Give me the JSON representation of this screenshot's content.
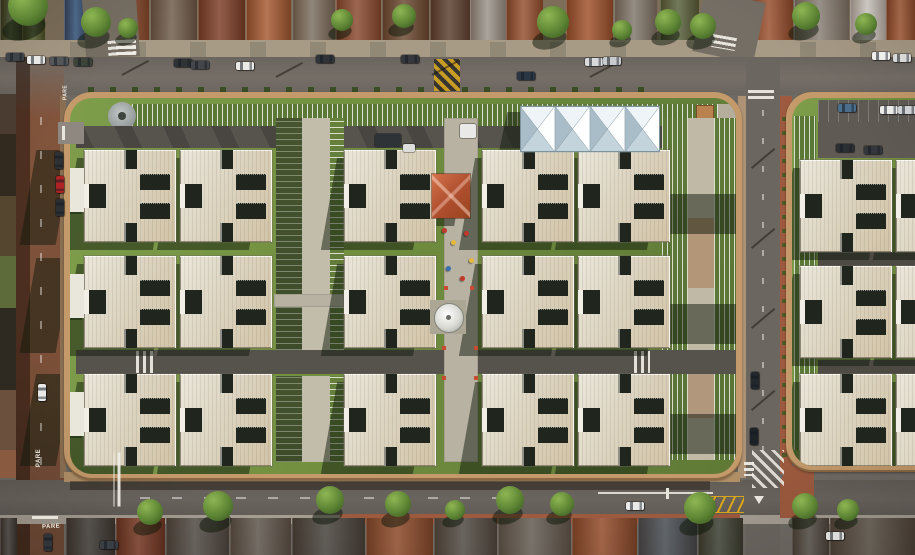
{
  "meta": {
    "scene_title": "Aerial drone view of a residential condominium complex with cross-shaped apartment blocks",
    "road_stop_text": "PARE"
  },
  "palette": {
    "grass": "#74923f",
    "grassDark": "#5d7a34",
    "shade": "rgba(16,26,11,0.5)",
    "roofLight": "#ebe7db",
    "roofMid": "#dcd4c0",
    "roofWarm": "#d2c3a6",
    "slot": "#20261d",
    "wall": "#c49a6a",
    "asphalt": "#716b64",
    "asphaltDark": "#57534d",
    "redRoad": "#7d5038",
    "sidewalk": "#a89b86",
    "sidewalkRed": "#9d5a3e",
    "sidewalkTan": "#b08f67",
    "concrete": "#c2bcaa",
    "path": "#b8b2a2",
    "tentWhite": "#f3f7f9",
    "tentShade": "#a9bdc8",
    "communityRoof": "#b65430",
    "tank": "#ecedea",
    "stripeLine": "rgba(248,248,240,0.8)"
  },
  "topHouses": [
    {
      "x": 0,
      "w": 22,
      "c": "#37411f"
    },
    {
      "x": 22,
      "w": 22,
      "c": "#4f5a2a"
    },
    {
      "x": 64,
      "w": 24,
      "c": "#30507a"
    },
    {
      "x": 92,
      "w": 56,
      "c": "#8f4e2e"
    },
    {
      "x": 150,
      "w": 46,
      "c": "#6e5d4c"
    },
    {
      "x": 198,
      "w": 46,
      "c": "#7c3f28"
    },
    {
      "x": 246,
      "w": 44,
      "c": "#a55a32"
    },
    {
      "x": 292,
      "w": 42,
      "c": "#7b6f60"
    },
    {
      "x": 336,
      "w": 44,
      "c": "#8a4a30"
    },
    {
      "x": 382,
      "w": 46,
      "c": "#6b4a32"
    },
    {
      "x": 430,
      "w": 40,
      "c": "#5a3f2e"
    },
    {
      "x": 470,
      "w": 36,
      "c": "#9a938a"
    },
    {
      "x": 506,
      "w": 36,
      "c": "#95502f"
    },
    {
      "x": 566,
      "w": 46,
      "c": "#a0522c"
    },
    {
      "x": 614,
      "w": 42,
      "c": "#80786c"
    },
    {
      "x": 660,
      "w": 38,
      "c": "#56603a"
    },
    {
      "x": 748,
      "w": 44,
      "c": "#9c512f"
    },
    {
      "x": 794,
      "w": 54,
      "c": "#8d857a"
    },
    {
      "x": 850,
      "w": 36,
      "c": "#d5d0c8"
    },
    {
      "x": 886,
      "w": 29,
      "c": "#a2552f"
    }
  ],
  "leftEdge": [
    {
      "y": 94,
      "h": 40,
      "c": "#4a3c30"
    },
    {
      "y": 134,
      "h": 62,
      "c": "#32291f"
    },
    {
      "y": 196,
      "h": 60,
      "c": "#55462f"
    },
    {
      "y": 256,
      "h": 52,
      "c": "#5d6b3a"
    },
    {
      "y": 308,
      "h": 82,
      "c": "#2e2a22"
    },
    {
      "y": 390,
      "h": 60,
      "c": "#6b513d"
    },
    {
      "y": 450,
      "h": 28,
      "c": "#8a5a40"
    }
  ],
  "topTrees": [
    {
      "x": 28,
      "y": 6,
      "r": 20
    },
    {
      "x": 96,
      "y": 22,
      "r": 15
    },
    {
      "x": 128,
      "y": 28,
      "r": 10
    },
    {
      "x": 342,
      "y": 20,
      "r": 11
    },
    {
      "x": 404,
      "y": 16,
      "r": 12
    },
    {
      "x": 553,
      "y": 22,
      "r": 16
    },
    {
      "x": 622,
      "y": 30,
      "r": 10
    },
    {
      "x": 668,
      "y": 22,
      "r": 13
    },
    {
      "x": 703,
      "y": 26,
      "r": 13
    },
    {
      "x": 806,
      "y": 16,
      "r": 14
    },
    {
      "x": 866,
      "y": 24,
      "r": 11
    }
  ],
  "bottomTrees": [
    {
      "x": 150,
      "y": 512,
      "r": 13
    },
    {
      "x": 218,
      "y": 506,
      "r": 15
    },
    {
      "x": 330,
      "y": 500,
      "r": 14
    },
    {
      "x": 398,
      "y": 504,
      "r": 13
    },
    {
      "x": 455,
      "y": 510,
      "r": 10
    },
    {
      "x": 510,
      "y": 500,
      "r": 14
    },
    {
      "x": 562,
      "y": 504,
      "r": 12
    },
    {
      "x": 700,
      "y": 508,
      "r": 16
    },
    {
      "x": 805,
      "y": 506,
      "r": 13
    },
    {
      "x": 848,
      "y": 510,
      "r": 11
    }
  ],
  "driveways": [
    70,
    130,
    190,
    250,
    310,
    370,
    430,
    490,
    550,
    610,
    800,
    860
  ],
  "cars": {
    "top": [
      {
        "x": 6,
        "y": 53,
        "c": "#3f4448"
      },
      {
        "x": 27,
        "y": 56,
        "c": "#e8e8e6"
      },
      {
        "x": 50,
        "y": 57,
        "c": "#53575a"
      },
      {
        "x": 74,
        "y": 58,
        "c": "#3c4438"
      },
      {
        "x": 174,
        "y": 59,
        "c": "#2f3336"
      },
      {
        "x": 191,
        "y": 61,
        "c": "#43474b"
      },
      {
        "x": 236,
        "y": 62,
        "c": "#eceae6"
      },
      {
        "x": 316,
        "y": 55,
        "c": "#303438"
      },
      {
        "x": 401,
        "y": 55,
        "c": "#34383c"
      },
      {
        "x": 517,
        "y": 72,
        "c": "#2b3644"
      },
      {
        "x": 585,
        "y": 58,
        "c": "#d9dadb"
      },
      {
        "x": 603,
        "y": 57,
        "c": "#c8cbcd"
      },
      {
        "x": 872,
        "y": 52,
        "c": "#eeeeec"
      },
      {
        "x": 893,
        "y": 54,
        "c": "#d8d8d6"
      }
    ],
    "left": [
      {
        "x": 55,
        "y": 152,
        "c": "#2e3234"
      },
      {
        "x": 56,
        "y": 176,
        "c": "#b02324"
      },
      {
        "x": 56,
        "y": 199,
        "c": "#2c3033"
      },
      {
        "x": 38,
        "y": 384,
        "c": "#e9e9e7"
      },
      {
        "x": 44,
        "y": 534,
        "c": "#303539"
      }
    ],
    "right": [
      {
        "x": 751,
        "y": 372,
        "c": "#23282c"
      },
      {
        "x": 750,
        "y": 428,
        "c": "#1e2327"
      }
    ],
    "bottom": [
      {
        "x": 100,
        "y": 541,
        "c": "#3a3f43"
      },
      {
        "x": 626,
        "y": 502,
        "c": "#e9eae8"
      },
      {
        "x": 826,
        "y": 532,
        "c": "#dcdcda"
      }
    ],
    "compoundDrive": [
      {
        "x": 305,
        "y": 36,
        "w": 26,
        "h": 13,
        "c": "#2e3338"
      },
      {
        "x": 390,
        "y": 26,
        "w": 16,
        "h": 14,
        "c": "#e9eae8"
      },
      {
        "x": 333,
        "y": 46,
        "w": 12,
        "h": 8,
        "c": "#dddddc"
      }
    ],
    "rightCompound": [
      {
        "x": 46,
        "y": 6,
        "c": "#4b6e8c"
      },
      {
        "x": 88,
        "y": 8,
        "c": "#ebebe9"
      },
      {
        "x": 106,
        "y": 8,
        "c": "#cfd2d4"
      },
      {
        "x": 44,
        "y": 46,
        "c": "#2b2f33"
      },
      {
        "x": 72,
        "y": 48,
        "c": "#33373b"
      }
    ]
  },
  "mainBuildings": [
    {
      "x": 14,
      "y": 52
    },
    {
      "x": 110,
      "y": 52
    },
    {
      "x": 274,
      "y": 52
    },
    {
      "x": 412,
      "y": 52
    },
    {
      "x": 508,
      "y": 52
    },
    {
      "x": 14,
      "y": 158
    },
    {
      "x": 110,
      "y": 158
    },
    {
      "x": 274,
      "y": 158
    },
    {
      "x": 412,
      "y": 158
    },
    {
      "x": 508,
      "y": 158
    },
    {
      "x": 14,
      "y": 276
    },
    {
      "x": 110,
      "y": 276
    },
    {
      "x": 274,
      "y": 276
    },
    {
      "x": 412,
      "y": 276
    },
    {
      "x": 508,
      "y": 276
    }
  ],
  "rightBuildings": [
    {
      "x": 8,
      "y": 62
    },
    {
      "x": 104,
      "y": 62
    },
    {
      "x": 8,
      "y": 168
    },
    {
      "x": 104,
      "y": 168
    },
    {
      "x": 8,
      "y": 276
    },
    {
      "x": 104,
      "y": 276
    }
  ],
  "entranceBlocks": [
    70,
    176,
    294
  ],
  "bottomHouses": [
    {
      "x": 0,
      "w": 16,
      "c": "#45413c"
    },
    {
      "x": 66,
      "w": 48,
      "c": "#45413c"
    },
    {
      "x": 116,
      "w": 48,
      "c": "#7e3d28"
    },
    {
      "x": 166,
      "w": 62,
      "c": "#57514b"
    },
    {
      "x": 230,
      "w": 60,
      "c": "#635b52"
    },
    {
      "x": 292,
      "w": 72,
      "c": "#4b4741"
    },
    {
      "x": 366,
      "w": 66,
      "c": "#8f4e2e"
    },
    {
      "x": 434,
      "w": 62,
      "c": "#544e47"
    },
    {
      "x": 498,
      "w": 72,
      "c": "#665f56"
    },
    {
      "x": 572,
      "w": 64,
      "c": "#95502f"
    },
    {
      "x": 638,
      "w": 58,
      "c": "#4c5258"
    },
    {
      "x": 698,
      "w": 44,
      "c": "#414639"
    },
    {
      "x": 792,
      "w": 36,
      "c": "#58524a"
    },
    {
      "x": 830,
      "w": 85,
      "c": "#5f564b"
    }
  ],
  "playground": [
    {
      "x": 372,
      "y": 130,
      "c": "#c0392b"
    },
    {
      "x": 381,
      "y": 142,
      "c": "#e6b93c"
    },
    {
      "x": 394,
      "y": 133,
      "c": "#c0392b"
    },
    {
      "x": 376,
      "y": 168,
      "c": "#3a6fb0"
    },
    {
      "x": 390,
      "y": 178,
      "c": "#c0392b"
    },
    {
      "x": 399,
      "y": 160,
      "c": "#e6b93c"
    }
  ]
}
